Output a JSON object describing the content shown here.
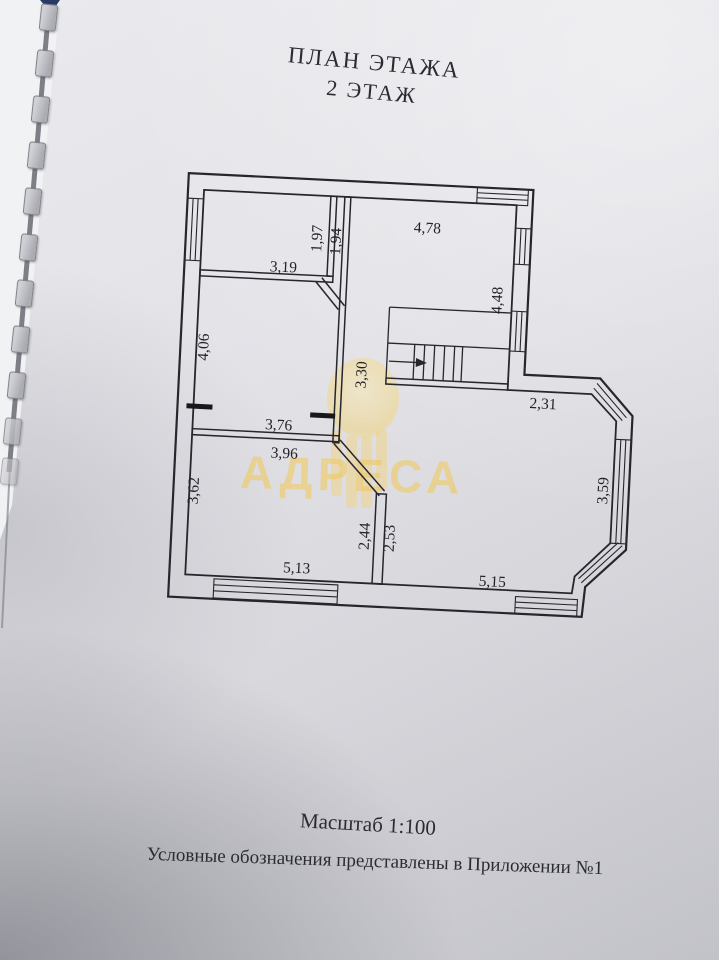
{
  "page": {
    "title_line1": "ПЛАН ЭТАЖА",
    "title_line2": "2 ЭТАЖ",
    "scale_note": "Масштаб 1:100",
    "legend_note": "Условные обозначения представлены в Приложении №1"
  },
  "watermark": {
    "brand_text": "АДРЕСА",
    "color": "#efcb64"
  },
  "floor_plan": {
    "stairs": {
      "arrow_direction": "right"
    },
    "dimensions": [
      {
        "value": "3,19",
        "orientation": "horizontal"
      },
      {
        "value": "1,97",
        "orientation": "vertical"
      },
      {
        "value": "1,94",
        "orientation": "vertical"
      },
      {
        "value": "4,78",
        "orientation": "horizontal"
      },
      {
        "value": "4,48",
        "orientation": "vertical"
      },
      {
        "value": "4,06",
        "orientation": "vertical"
      },
      {
        "value": "3,30",
        "orientation": "vertical"
      },
      {
        "value": "3,76",
        "orientation": "horizontal"
      },
      {
        "value": "3,96",
        "orientation": "horizontal"
      },
      {
        "value": "2,31",
        "orientation": "horizontal"
      },
      {
        "value": "3,62",
        "orientation": "vertical"
      },
      {
        "value": "2,44",
        "orientation": "vertical"
      },
      {
        "value": "2,53",
        "orientation": "vertical"
      },
      {
        "value": "5,13",
        "orientation": "horizontal"
      },
      {
        "value": "5,15",
        "orientation": "horizontal"
      },
      {
        "value": "3,59",
        "orientation": "vertical"
      }
    ]
  },
  "colors": {
    "paper": "#d9d9de",
    "line": "#26262c",
    "binding_tab": "#b9b9bf",
    "corner_accent": "#2a3a66"
  }
}
